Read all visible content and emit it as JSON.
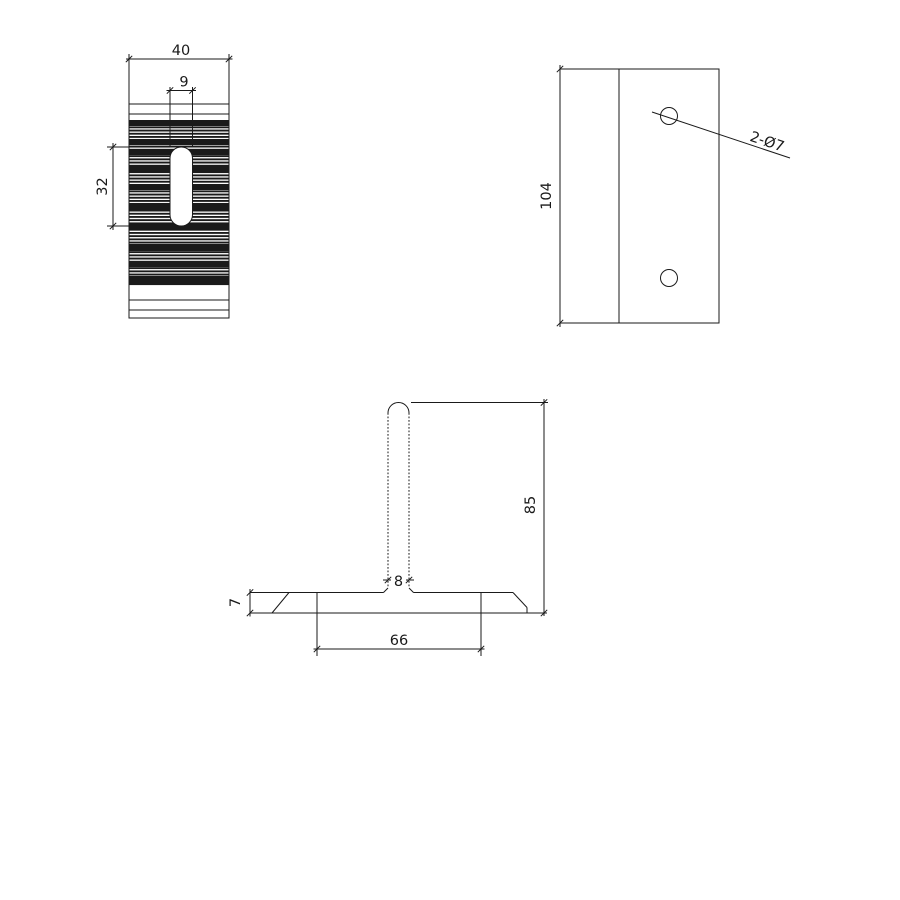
{
  "views": {
    "front": {
      "width_dim": "40",
      "slot_width_dim": "9",
      "slot_length_dim": "32"
    },
    "side": {
      "height_dim": "104",
      "hole_callout": "2-Ø7"
    },
    "profile": {
      "stem_height_dim": "85",
      "stem_width_dim": "8",
      "base_thickness_dim": "7",
      "base_span_dim": "66"
    }
  },
  "colors": {
    "line": "#1a1a1a",
    "background": "#ffffff"
  }
}
